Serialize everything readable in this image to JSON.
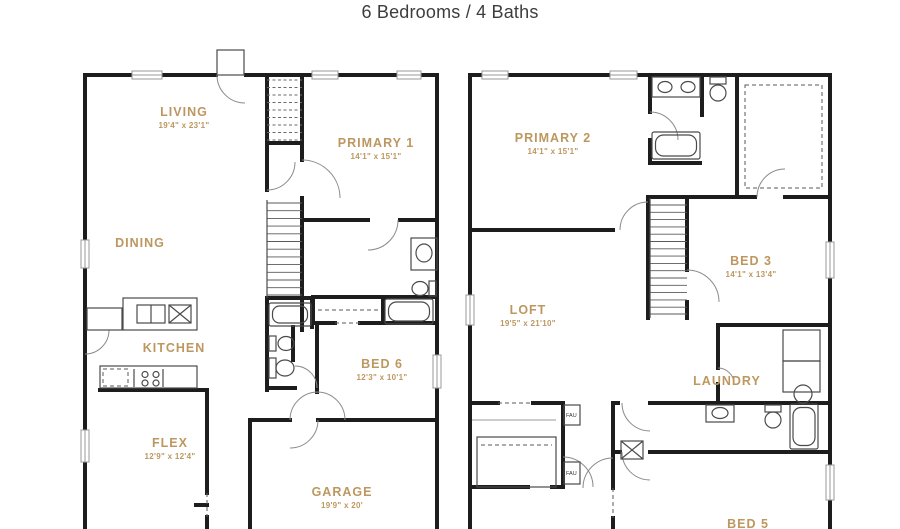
{
  "title": "6 Bedrooms / 4 Baths",
  "colors": {
    "room_label": "#bd9760",
    "walls": "#1d1d1d",
    "title_text": "#3d3d3d",
    "background": "#ffffff"
  },
  "floor1": {
    "rooms": [
      {
        "label": "LIVING",
        "dims": "19'4\" x 23'1\""
      },
      {
        "label": "PRIMARY 1",
        "dims": "14'1\" x 15'1\""
      },
      {
        "label": "DINING",
        "dims": ""
      },
      {
        "label": "KITCHEN",
        "dims": ""
      },
      {
        "label": "FLEX",
        "dims": "12'9\" x 12'4\""
      },
      {
        "label": "BED 6",
        "dims": "12'3\" x 10'1\""
      },
      {
        "label": "GARAGE",
        "dims": "19'9\" x 20'"
      }
    ]
  },
  "floor2": {
    "rooms": [
      {
        "label": "PRIMARY 2",
        "dims": "14'1\" x 15'1\""
      },
      {
        "label": "BED 3",
        "dims": "14'1\" x 13'4\""
      },
      {
        "label": "LOFT",
        "dims": "19'5\" x 21'10\""
      },
      {
        "label": "LAUNDRY",
        "dims": ""
      },
      {
        "label": "BED 5",
        "dims": ""
      }
    ]
  },
  "fixtures": {
    "fau_label": "FAU"
  }
}
